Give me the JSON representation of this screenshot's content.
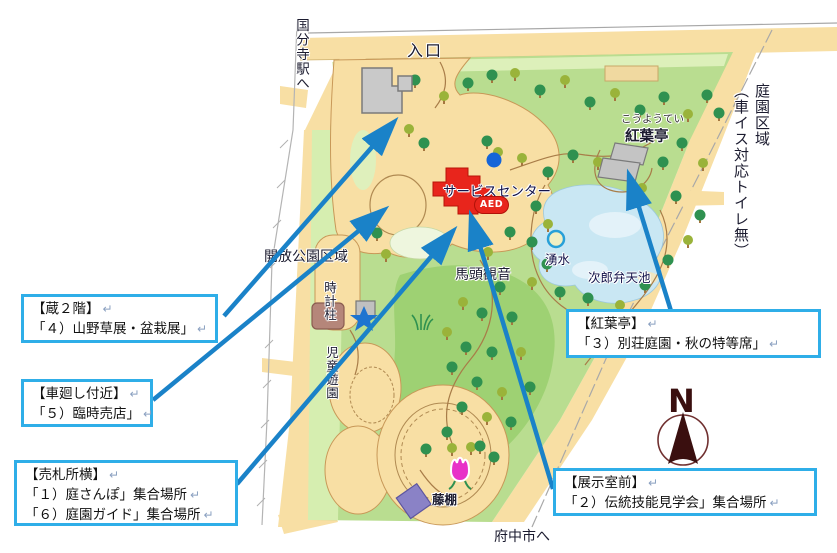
{
  "map_labels": {
    "entrance": "入口",
    "to_kokubunji": "国分寺駅へ",
    "garden_zone": "庭園区域",
    "garden_zone_note": "（車イス対応トイレ無）",
    "open_park_zone": "開放公園区域",
    "service_center": "サービスセンター",
    "aed": "AED",
    "bato_kannon": "馬頭観音",
    "spring": "湧水",
    "jiro_benten_pond": "次郎弁天池",
    "koyotei_kana": "こうようてい",
    "koyotei": "紅葉亭",
    "clock_pillar": "時計柱",
    "childrens_park": "児童遊園",
    "wisteria_trellis": "藤棚",
    "to_fuchu": "府中市へ",
    "north": "N"
  },
  "return_mark": "↵",
  "callouts": [
    {
      "id": "kura-2f",
      "lines": [
        "【蔵２階】",
        "「４）山野草展・盆栽展」"
      ]
    },
    {
      "id": "kurumamawashi",
      "lines": [
        "【車廻し付近】",
        "「５）臨時売店」"
      ]
    },
    {
      "id": "ticket-booth",
      "lines": [
        "【売札所横】",
        "「１）庭さんぽ」集合場所",
        "「６）庭園ガイド」集合場所"
      ]
    },
    {
      "id": "koyotei",
      "lines": [
        "【紅葉亭】",
        "「３）別荘庭園・秋の特等席」"
      ]
    },
    {
      "id": "exhibit-room",
      "lines": [
        "【展示室前】",
        "「２）伝統技能見学会」集合場所"
      ]
    }
  ],
  "colors": {
    "road_tan": "#f8dfa4",
    "park_green": "#b9dd90",
    "pond_blue": "#c9e7f3",
    "building_red": "#e8251c",
    "building_gray": "#c9c9c9",
    "arrow_blue": "#1a82c8",
    "callout_border": "#2faee8",
    "compass_brown": "#3a0f0f"
  }
}
